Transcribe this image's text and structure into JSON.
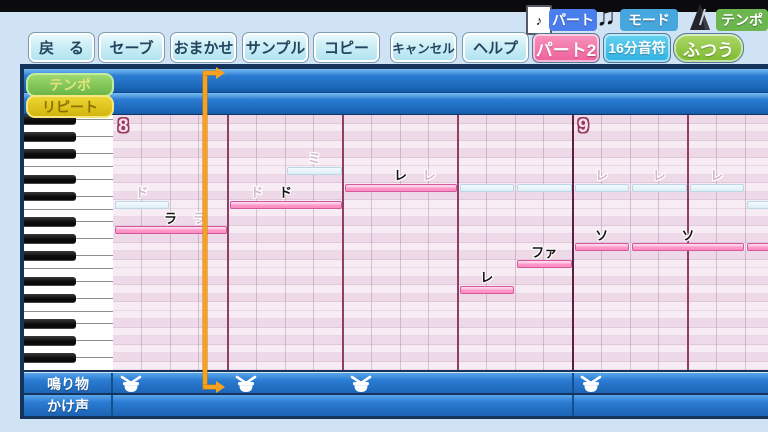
{
  "topbar": {
    "indicators": [
      {
        "icon": "sheet-music-icon",
        "label": "パート",
        "color": "#4a7eec"
      },
      {
        "icon": "music-note-icon",
        "label": "モード",
        "color": "#46a6de"
      },
      {
        "icon": "metronome-icon",
        "label": "テンポ",
        "color": "#6cb650"
      }
    ]
  },
  "toolbar": {
    "buttons": [
      "戻　る",
      "セーブ",
      "おまかせ",
      "サンプル",
      "コピー",
      "キャンセル",
      "ヘルプ"
    ]
  },
  "status_chips": [
    {
      "label": "パート2",
      "color_top": "#f795bd",
      "color_bottom": "#ef5f9b"
    },
    {
      "label": "16分音符",
      "color_top": "#66d2f0",
      "color_bottom": "#2cb2e4"
    },
    {
      "label": "ふつう",
      "color_top": "#aed868",
      "color_bottom": "#7cba30"
    }
  ],
  "side_buttons": [
    {
      "label": "テンポ",
      "bg_top": "#9ed86e",
      "bg_bottom": "#6cb648",
      "border": "#c2eca0",
      "text_color": "#e0e37a"
    },
    {
      "label": "リピート",
      "bg_top": "#eed532",
      "bg_bottom": "#d2b60e",
      "border": "#f6e87e",
      "text_color": "#8a7200"
    }
  ],
  "piano_roll": {
    "measures": [
      {
        "number": "8",
        "cell": 0
      },
      {
        "number": "9",
        "cell": 16
      }
    ],
    "grid": {
      "cells_per_beat": 4,
      "beats_per_measure": 4,
      "visible_cells": 23
    },
    "notes": [
      {
        "label": "ラ",
        "row": 13,
        "start": 0,
        "len": 4
      },
      {
        "label": "ド",
        "row": 10,
        "start": 4,
        "len": 4
      },
      {
        "label": "レ",
        "row": 8,
        "start": 8,
        "len": 4
      },
      {
        "label": "レ",
        "row": 20,
        "start": 12,
        "len": 2
      },
      {
        "label": "ファ",
        "row": 17,
        "start": 14,
        "len": 2
      },
      {
        "label": "ソ",
        "row": 15,
        "start": 16,
        "len": 2
      },
      {
        "label": "ソ",
        "row": 15,
        "start": 18,
        "len": 4
      },
      {
        "label": "",
        "row": 15,
        "start": 22,
        "len": 2
      }
    ],
    "ghost_notes": [
      {
        "label": "ド",
        "row": 10,
        "start": 0,
        "len": 2
      },
      {
        "label": "ラ",
        "row": 13,
        "start": 2,
        "len": 2
      },
      {
        "label": "ド",
        "row": 10,
        "start": 4,
        "len": 2
      },
      {
        "label": "ミ",
        "row": 6,
        "start": 6,
        "len": 2
      },
      {
        "label": "レ",
        "row": 8,
        "start": 10,
        "len": 2
      },
      {
        "label": "",
        "row": 8,
        "start": 12,
        "len": 2
      },
      {
        "label": "",
        "row": 8,
        "start": 14,
        "len": 2
      },
      {
        "label": "レ",
        "row": 8,
        "start": 16,
        "len": 2
      },
      {
        "label": "レ",
        "row": 8,
        "start": 18,
        "len": 2
      },
      {
        "label": "レ",
        "row": 8,
        "start": 20,
        "len": 2
      },
      {
        "label": "",
        "row": 10,
        "start": 22,
        "len": 2
      }
    ],
    "playhead_cell": 3.2
  },
  "tracks": [
    {
      "label": "鳴り物",
      "hit_cells": [
        0,
        4,
        8,
        16
      ]
    },
    {
      "label": "かけ声",
      "hit_cells": []
    }
  ],
  "colors": {
    "note_pink": "#ff9ccb",
    "ghost_blue": "#ddeef7",
    "playhead_orange": "#f6a11f",
    "measure_maroon": "#9a3a5e",
    "beat_line": "#8f3f63",
    "header_blue": "#2a7cd2"
  }
}
